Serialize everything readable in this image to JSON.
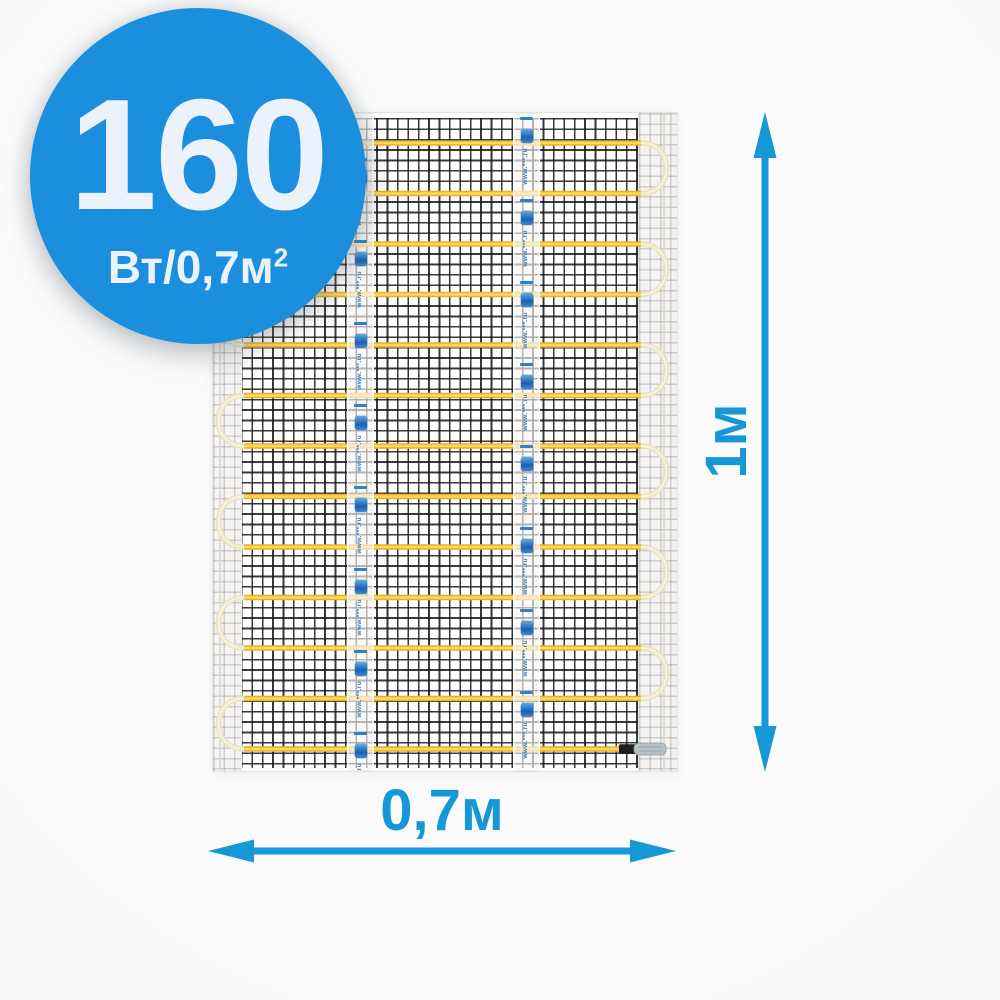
{
  "badge": {
    "value": "160",
    "unit_main": "Вт/0,7м",
    "unit_sup": "2",
    "bg_color": "#1b8fdd",
    "text_color": "#ecf2fb"
  },
  "dimensions": {
    "height_label": "1м",
    "width_label": "0,7м",
    "arrow_color": "#1697d6"
  },
  "mat": {
    "lines_count": 13,
    "tape_units": 8,
    "tape_url_text": "www.***.ru",
    "mesh_color": "#161616",
    "cable_color_outer": "#e9ae2a",
    "cable_color_inner": "#ffd95c",
    "loop_color_outer": "#eae1c3",
    "loop_color_inner": "#f6f1de",
    "connector_sleeve_color": "#1c1c1c",
    "connector_tip_color": "#b6c1c6"
  }
}
